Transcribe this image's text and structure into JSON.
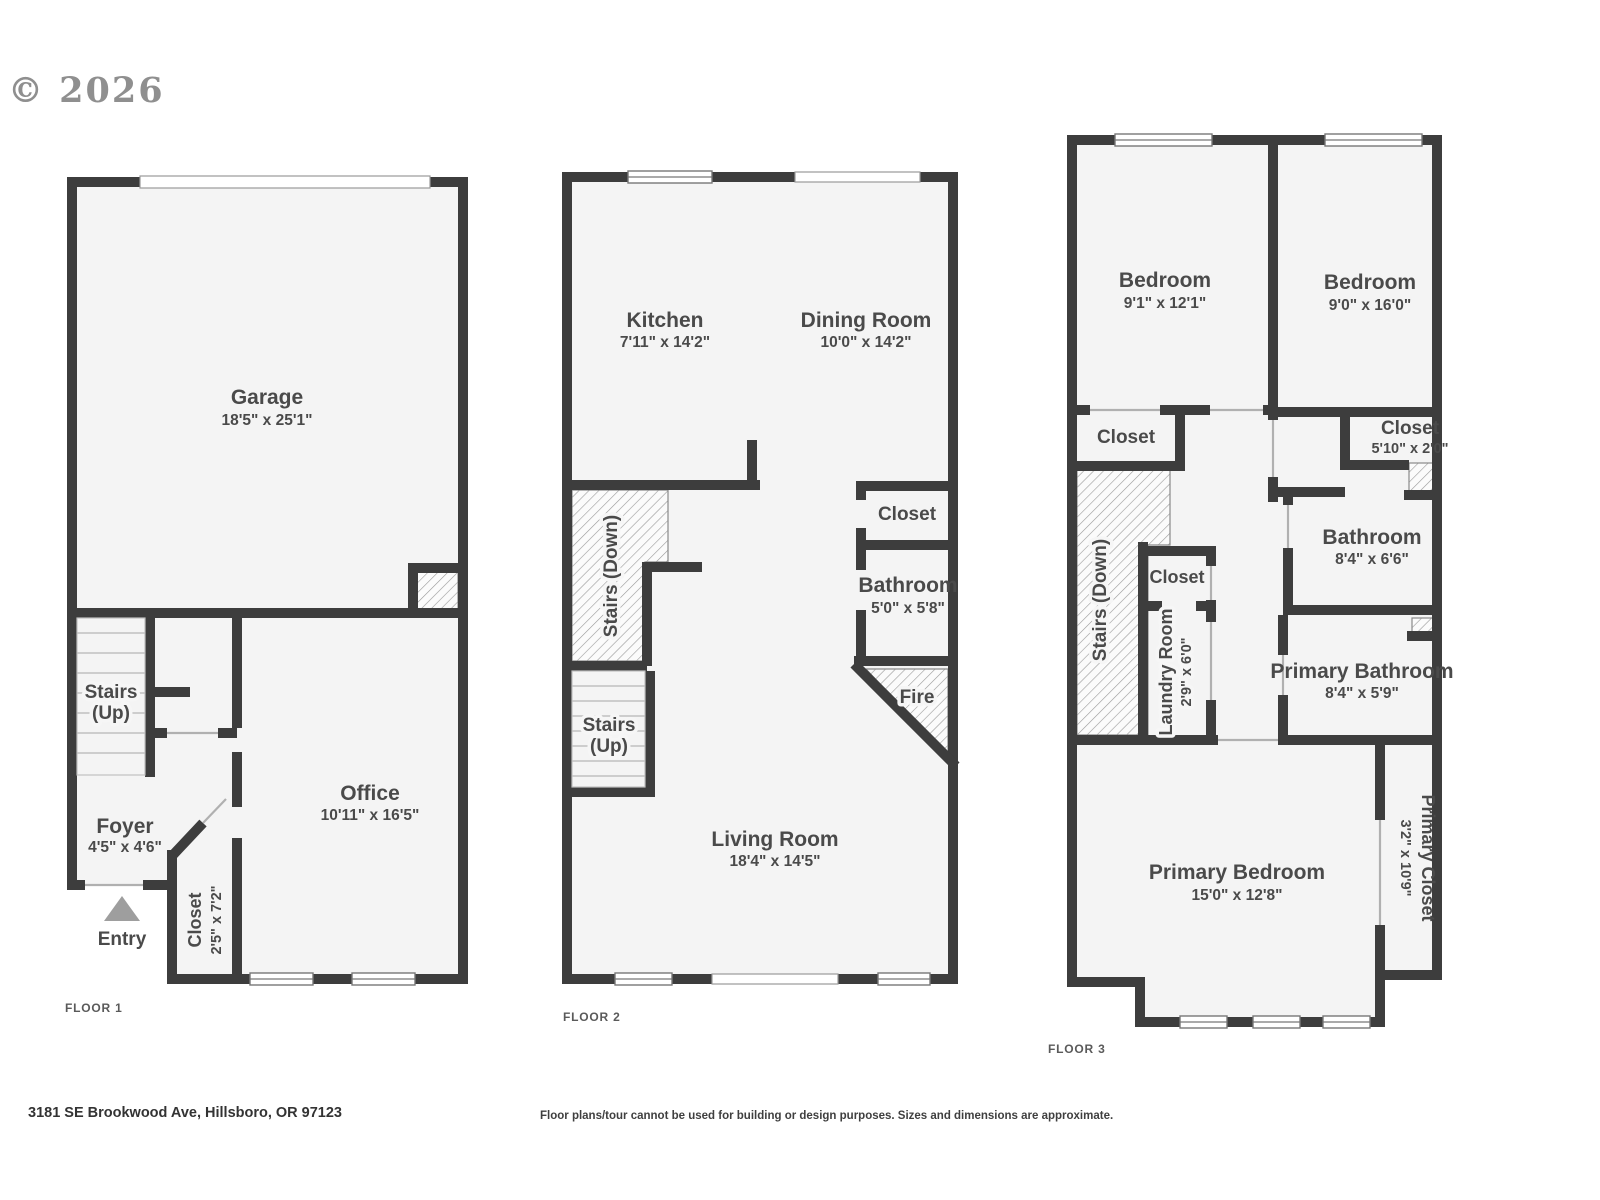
{
  "meta": {
    "copyright": "© 2026",
    "address": "3181 SE Brookwood Ave, Hillsboro, OR 97123",
    "disclaimer": "Floor plans/tour cannot be used for building or design purposes. Sizes and dimensions are approximate."
  },
  "colors": {
    "wall": "#3d3d3d",
    "room_fill": "#f4f4f4",
    "label": "#4a4a4a",
    "copyright": "#8f8f8f",
    "entry_arrow": "#9e9e9e"
  },
  "floor1": {
    "label": "FLOOR 1",
    "garage_name": "Garage",
    "garage_dims": "18'5\" x 25'1\"",
    "stairs_line1": "Stairs",
    "stairs_line2": "(Up)",
    "foyer_name": "Foyer",
    "foyer_dims": "4'5\" x 4'6\"",
    "entry": "Entry",
    "closet_name": "Closet",
    "closet_dims": "2'5\" x 7'2\"",
    "office_name": "Office",
    "office_dims": "10'11\" x 16'5\""
  },
  "floor2": {
    "label": "FLOOR 2",
    "kitchen_name": "Kitchen",
    "kitchen_dims": "7'11\" x 14'2\"",
    "dining_name": "Dining Room",
    "dining_dims": "10'0\" x 14'2\"",
    "stairs_down": "Stairs (Down)",
    "stairs_up_line1": "Stairs",
    "stairs_up_line2": "(Up)",
    "closet_name": "Closet",
    "bathroom_name": "Bathroom",
    "bathroom_dims": "5'0\" x 5'8\"",
    "fire": "Fire",
    "living_name": "Living Room",
    "living_dims": "18'4\" x 14'5\""
  },
  "floor3": {
    "label": "FLOOR 3",
    "bedroom1_name": "Bedroom",
    "bedroom1_dims": "9'1\" x 12'1\"",
    "bedroom2_name": "Bedroom",
    "bedroom2_dims": "9'0\" x 16'0\"",
    "closet_left": "Closet",
    "closet_right_name": "Closet",
    "closet_right_dims": "5'10\" x 2'0\"",
    "stairs_down": "Stairs (Down)",
    "closet_mid": "Closet",
    "laundry_name": "Laundry Room",
    "laundry_dims": "2'9\" x 6'0\"",
    "bathroom_name": "Bathroom",
    "bathroom_dims": "8'4\" x 6'6\"",
    "primary_bath_name": "Primary Bathroom",
    "primary_bath_dims": "8'4\" x 5'9\"",
    "primary_bed_name": "Primary Bedroom",
    "primary_bed_dims": "15'0\" x 12'8\"",
    "primary_closet_name": "Primary Closet",
    "primary_closet_dims": "3'2\" x 10'9\""
  }
}
